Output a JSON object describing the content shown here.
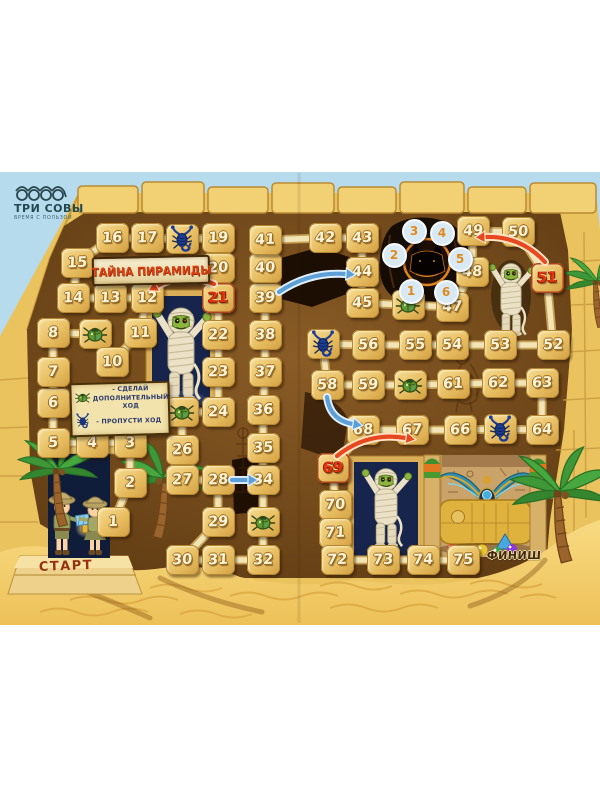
{
  "publisher": {
    "name": "ТРИ СОВЫ",
    "tagline": "ВРЕМЯ С ПОЛЬЗОЙ"
  },
  "board": {
    "title": "ТАЙНА ПИРАМИДЫ",
    "start_label": "СТАРТ",
    "finish_label": "ФИНИШ",
    "legend": {
      "extra_move": "- СДЕЛАЙ ДОПОЛНИТЕЛЬНЫЙ ХОД",
      "skip_turn": "- ПРОПУСТИ ХОД"
    },
    "spinner": {
      "numbers": [
        1,
        2,
        3,
        4,
        5,
        6
      ]
    },
    "colors": {
      "tile_number": "#fdf4da",
      "red_number": "#e8350c",
      "arrow_back": "#e8481f",
      "arrow_shortcut": "#5d9fd8",
      "path_beam": "#f2e4b4"
    },
    "tiles": [
      {
        "n": 1,
        "x": 113,
        "y": 522,
        "t": "n"
      },
      {
        "n": 2,
        "x": 130,
        "y": 483,
        "t": "n"
      },
      {
        "n": 3,
        "x": 130,
        "y": 443,
        "t": "n"
      },
      {
        "n": 4,
        "x": 92,
        "y": 443,
        "t": "n"
      },
      {
        "n": 5,
        "x": 53,
        "y": 443,
        "t": "n"
      },
      {
        "n": 6,
        "x": 53,
        "y": 403,
        "t": "n"
      },
      {
        "n": 7,
        "x": 53,
        "y": 372,
        "t": "n"
      },
      {
        "n": 8,
        "x": 53,
        "y": 333,
        "t": "n"
      },
      {
        "n": 9,
        "x": 95,
        "y": 334,
        "t": "a"
      },
      {
        "n": 10,
        "x": 112,
        "y": 362,
        "t": "n"
      },
      {
        "n": 11,
        "x": 140,
        "y": 333,
        "t": "n"
      },
      {
        "n": 12,
        "x": 147,
        "y": 298,
        "t": "n"
      },
      {
        "n": 13,
        "x": 110,
        "y": 298,
        "t": "n"
      },
      {
        "n": 14,
        "x": 73,
        "y": 298,
        "t": "n"
      },
      {
        "n": 15,
        "x": 77,
        "y": 263,
        "t": "n"
      },
      {
        "n": 16,
        "x": 112,
        "y": 238,
        "t": "n"
      },
      {
        "n": 17,
        "x": 147,
        "y": 238,
        "t": "n"
      },
      {
        "n": 18,
        "x": 182,
        "y": 239,
        "t": "s"
      },
      {
        "n": 19,
        "x": 218,
        "y": 238,
        "t": "n"
      },
      {
        "n": 20,
        "x": 218,
        "y": 268,
        "t": "n"
      },
      {
        "n": 21,
        "x": 218,
        "y": 298,
        "t": "r"
      },
      {
        "n": 22,
        "x": 218,
        "y": 335,
        "t": "n"
      },
      {
        "n": 23,
        "x": 218,
        "y": 372,
        "t": "n"
      },
      {
        "n": 24,
        "x": 218,
        "y": 412,
        "t": "n"
      },
      {
        "n": 25,
        "x": 182,
        "y": 412,
        "t": "a"
      },
      {
        "n": 26,
        "x": 182,
        "y": 450,
        "t": "n"
      },
      {
        "n": 27,
        "x": 182,
        "y": 480,
        "t": "n"
      },
      {
        "n": 28,
        "x": 218,
        "y": 480,
        "t": "n"
      },
      {
        "n": 29,
        "x": 218,
        "y": 522,
        "t": "n"
      },
      {
        "n": 30,
        "x": 182,
        "y": 560,
        "t": "n"
      },
      {
        "n": 31,
        "x": 218,
        "y": 560,
        "t": "n"
      },
      {
        "n": 32,
        "x": 263,
        "y": 560,
        "t": "n"
      },
      {
        "n": 33,
        "x": 263,
        "y": 522,
        "t": "a"
      },
      {
        "n": 34,
        "x": 263,
        "y": 480,
        "t": "n"
      },
      {
        "n": 35,
        "x": 263,
        "y": 448,
        "t": "n"
      },
      {
        "n": 36,
        "x": 263,
        "y": 410,
        "t": "n"
      },
      {
        "n": 37,
        "x": 265,
        "y": 372,
        "t": "n"
      },
      {
        "n": 38,
        "x": 265,
        "y": 335,
        "t": "n"
      },
      {
        "n": 39,
        "x": 265,
        "y": 298,
        "t": "n"
      },
      {
        "n": 40,
        "x": 265,
        "y": 268,
        "t": "n"
      },
      {
        "n": 41,
        "x": 265,
        "y": 240,
        "t": "n"
      },
      {
        "n": 42,
        "x": 325,
        "y": 238,
        "t": "n"
      },
      {
        "n": 43,
        "x": 362,
        "y": 238,
        "t": "n"
      },
      {
        "n": 44,
        "x": 362,
        "y": 272,
        "t": "n"
      },
      {
        "n": 45,
        "x": 362,
        "y": 303,
        "t": "n"
      },
      {
        "n": 46,
        "x": 408,
        "y": 305,
        "t": "a"
      },
      {
        "n": 47,
        "x": 452,
        "y": 307,
        "t": "n"
      },
      {
        "n": 48,
        "x": 472,
        "y": 272,
        "t": "n"
      },
      {
        "n": 49,
        "x": 473,
        "y": 231,
        "t": "n"
      },
      {
        "n": 50,
        "x": 518,
        "y": 232,
        "t": "n"
      },
      {
        "n": 51,
        "x": 547,
        "y": 278,
        "t": "r"
      },
      {
        "n": 52,
        "x": 553,
        "y": 345,
        "t": "n"
      },
      {
        "n": 53,
        "x": 500,
        "y": 345,
        "t": "n"
      },
      {
        "n": 54,
        "x": 452,
        "y": 345,
        "t": "n"
      },
      {
        "n": 55,
        "x": 415,
        "y": 345,
        "t": "n"
      },
      {
        "n": 56,
        "x": 368,
        "y": 345,
        "t": "n"
      },
      {
        "n": 57,
        "x": 323,
        "y": 344,
        "t": "s"
      },
      {
        "n": 58,
        "x": 327,
        "y": 385,
        "t": "n"
      },
      {
        "n": 59,
        "x": 368,
        "y": 385,
        "t": "n"
      },
      {
        "n": 60,
        "x": 410,
        "y": 385,
        "t": "a"
      },
      {
        "n": 61,
        "x": 453,
        "y": 384,
        "t": "n"
      },
      {
        "n": 62,
        "x": 498,
        "y": 383,
        "t": "n"
      },
      {
        "n": 63,
        "x": 542,
        "y": 383,
        "t": "n"
      },
      {
        "n": 64,
        "x": 542,
        "y": 430,
        "t": "n"
      },
      {
        "n": 65,
        "x": 500,
        "y": 429,
        "t": "s"
      },
      {
        "n": 66,
        "x": 460,
        "y": 430,
        "t": "n"
      },
      {
        "n": 67,
        "x": 412,
        "y": 430,
        "t": "n"
      },
      {
        "n": 68,
        "x": 363,
        "y": 430,
        "t": "n"
      },
      {
        "n": 69,
        "x": 333,
        "y": 468,
        "t": "r"
      },
      {
        "n": 70,
        "x": 335,
        "y": 505,
        "t": "n"
      },
      {
        "n": 71,
        "x": 335,
        "y": 533,
        "t": "n"
      },
      {
        "n": 72,
        "x": 337,
        "y": 560,
        "t": "n"
      },
      {
        "n": 73,
        "x": 383,
        "y": 560,
        "t": "n"
      },
      {
        "n": 74,
        "x": 423,
        "y": 560,
        "t": "n"
      },
      {
        "n": 75,
        "x": 463,
        "y": 560,
        "t": "n"
      }
    ],
    "arrows": {
      "back": [
        [
          21,
          12
        ],
        [
          51,
          49
        ],
        [
          69,
          67
        ]
      ],
      "shortcut": [
        [
          28,
          34
        ],
        [
          39,
          44
        ],
        [
          58,
          68
        ]
      ]
    }
  }
}
